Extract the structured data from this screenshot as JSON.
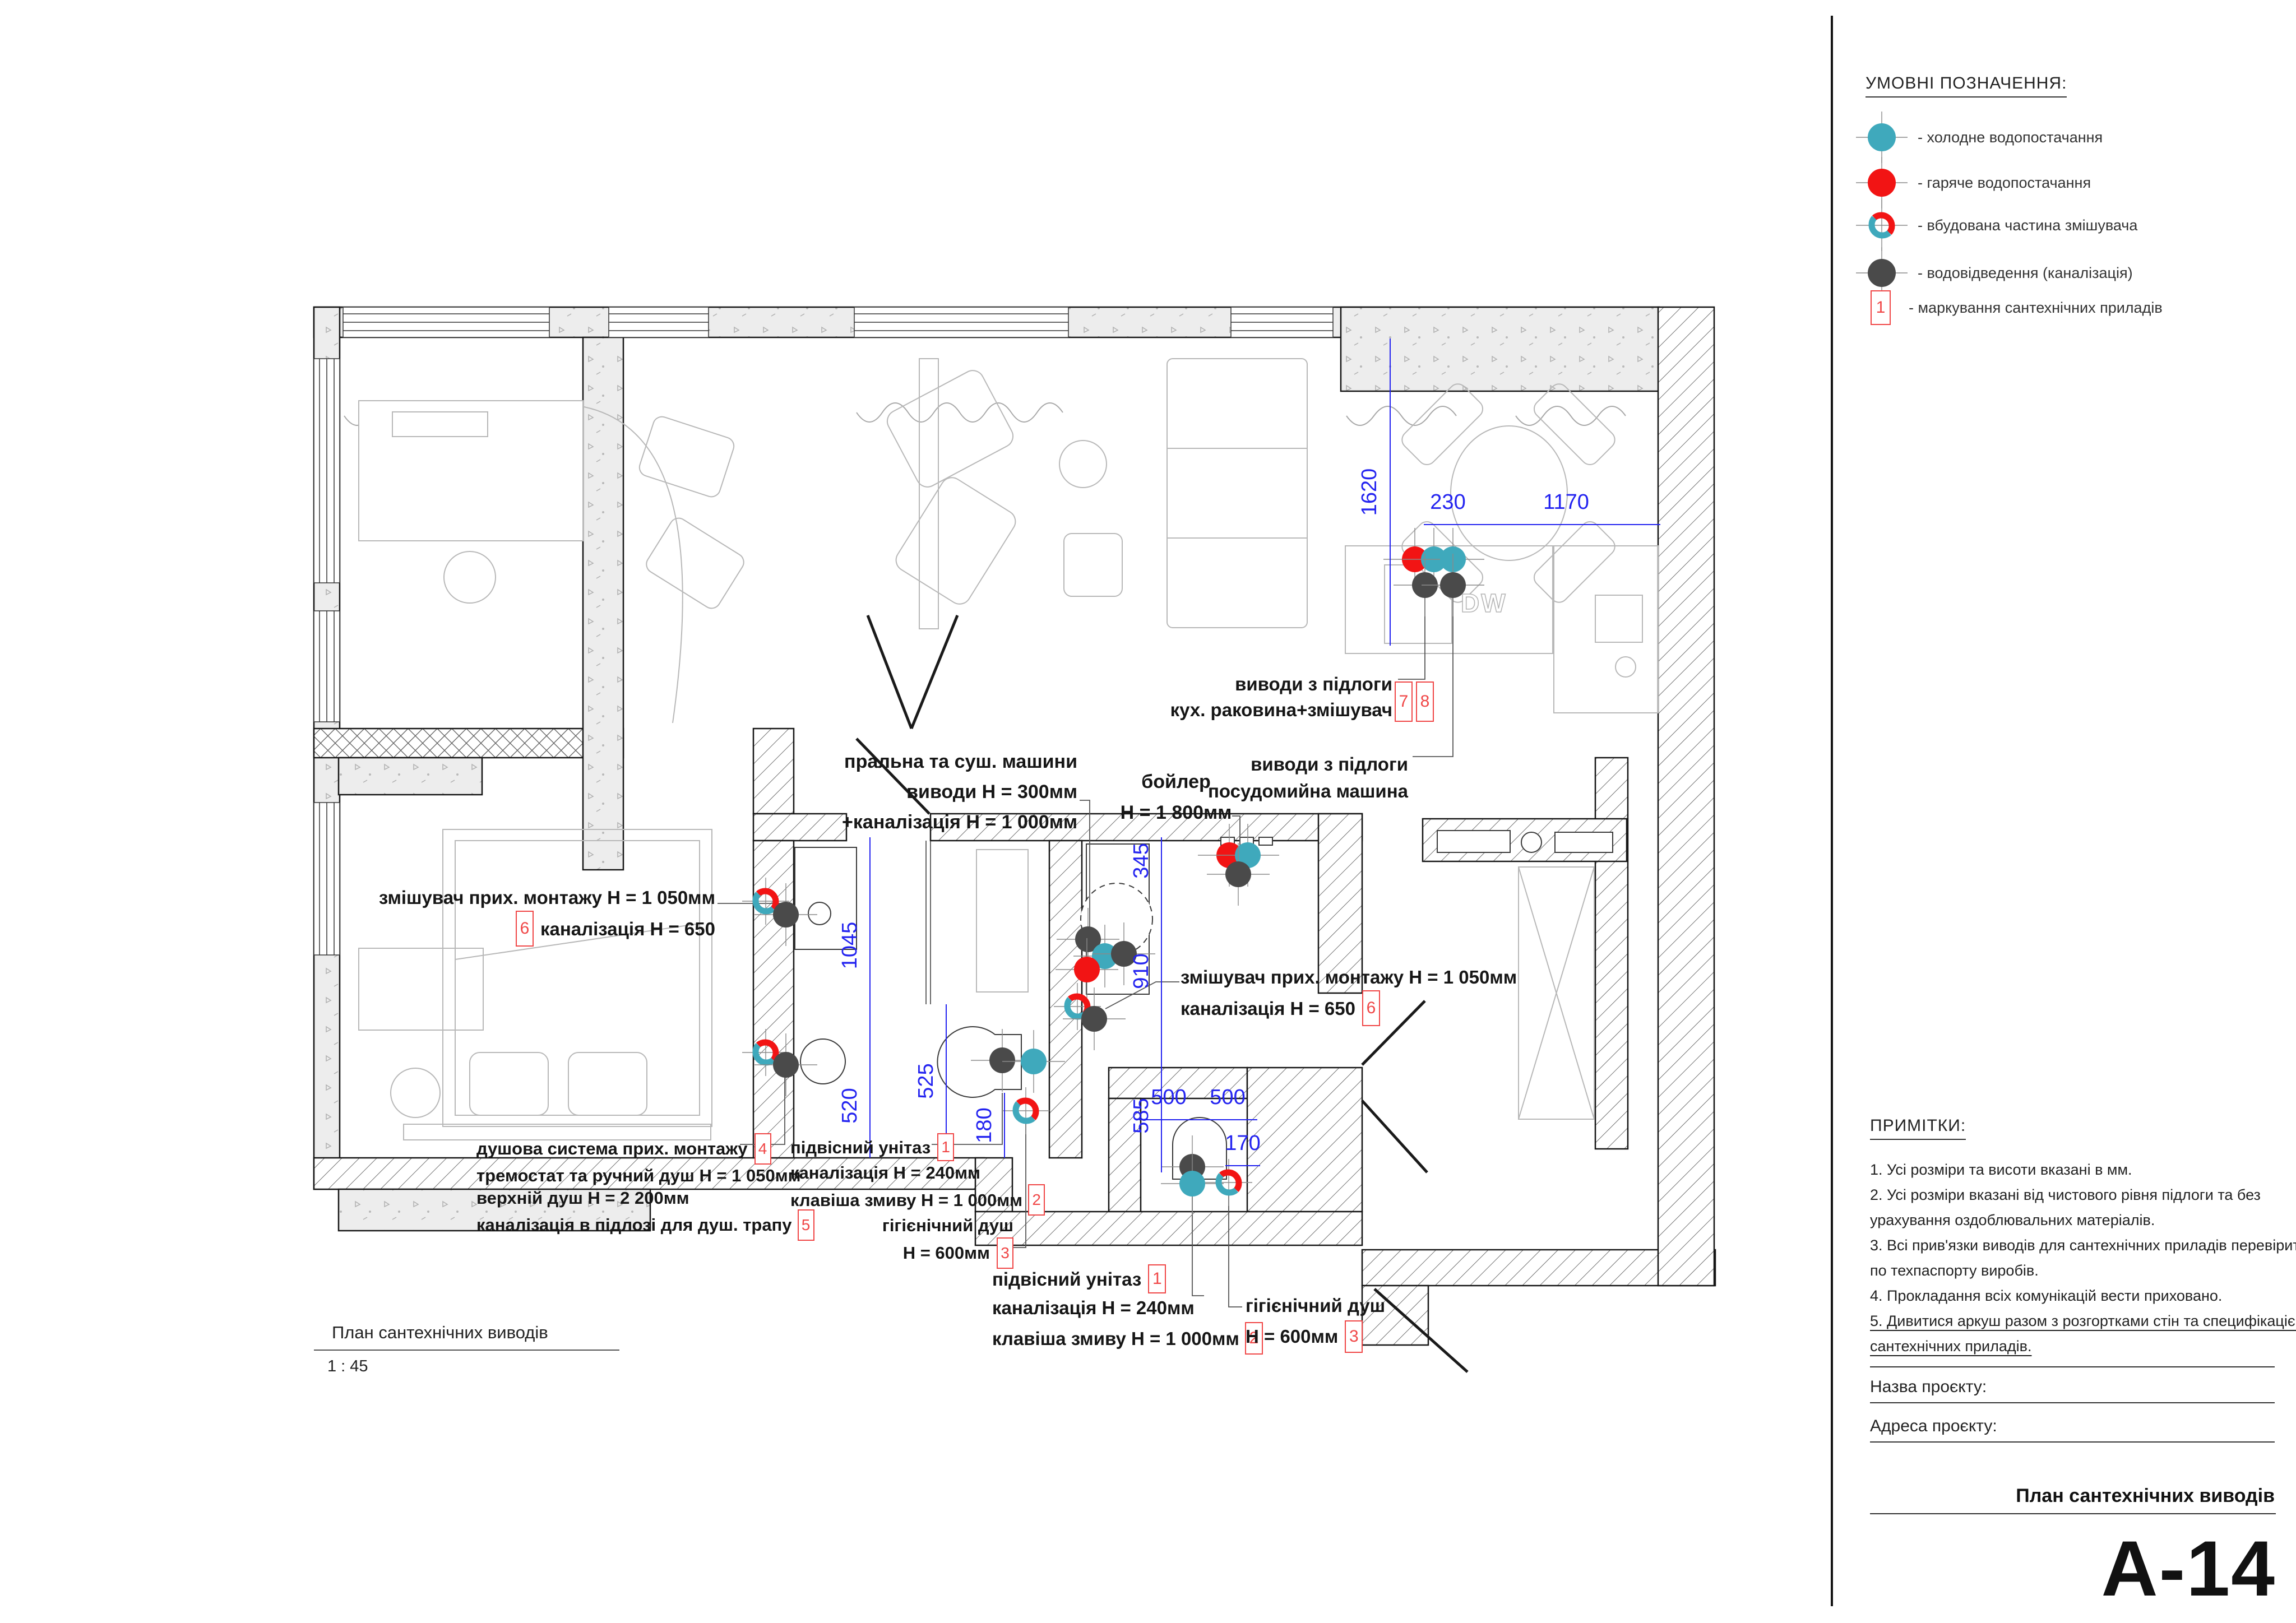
{
  "legend": {
    "title": "УМОВНІ ПОЗНАЧЕННЯ:",
    "items": [
      {
        "key": "cold",
        "label": "- холодне водопостачання"
      },
      {
        "key": "hot",
        "label": "- гаряче водопостачання"
      },
      {
        "key": "mixer",
        "label": "- вбудована частина змішувача"
      },
      {
        "key": "drain",
        "label": "- водовідведення (каналізація)"
      },
      {
        "key": "number",
        "box": "1",
        "label": "- маркування сантехнічних приладів"
      }
    ]
  },
  "notes": {
    "title": "ПРИМІТКИ:",
    "lines": [
      "1. Усі розміри та висоти вказані в мм.",
      "2. Усі розміри вказані від чистового рівня підлоги та без",
      "урахування оздоблювальних матеріалів.",
      "3. Всі прив'язки виводів для сантехнічних приладів перевірити",
      "по техпаспорту виробів.",
      "4. Прокладання всіх комунікацій вести приховано.",
      "5. Дивитися аркуш разом з розгортками стін та специфікацією",
      "сантехнічних приладів."
    ]
  },
  "title_block": {
    "name_label": "Назва проєкту:",
    "address_label": "Адреса проєкту:",
    "sheet_title": "План сантехнічних виводів",
    "sheet_number": "А-14"
  },
  "plan_caption": {
    "title": "План сантехнічних виводів",
    "scale": "1 : 45"
  },
  "dims": {
    "v1620": "1620",
    "v230": "230",
    "v1170": "1170",
    "v345": "345",
    "v910": "910",
    "v585": "585",
    "v1045": "1045",
    "v520": "520",
    "v525": "525",
    "v180": "180",
    "v500a": "500",
    "v500b": "500",
    "v170": "170"
  },
  "labels": {
    "washer": {
      "l1": "пральна та суш. машини",
      "l2": "виводи Н = 300мм",
      "l3": "+каналізація Н = 1 000мм"
    },
    "boiler": {
      "l1": "бойлер",
      "l2": "Н = 1 800мм"
    },
    "sink_floor": {
      "l1": "виводи з підлоги",
      "l2": "кух. раковина+змішувач",
      "b1": "7",
      "b2": "8"
    },
    "dw_floor": {
      "l1": "виводи з підлоги",
      "l2": "посудомийна машина"
    },
    "mixer_left": {
      "l1": "змішувач прих. монтажу Н = 1 050мм",
      "b": "6",
      "l2": "каналізація Н = 650"
    },
    "mixer_right": {
      "l1": "змішувач прих. монтажу Н = 1 050мм",
      "l2": "каналізація Н = 650",
      "b": "6"
    },
    "shower": {
      "l1": "душова система прих. монтажу",
      "b1": "4",
      "l2": "тремостат та ручний душ Н = 1 050мм",
      "l3": "верхній душ Н = 2 200мм",
      "l4": "каналізація в підлозі для душ. трапу",
      "b2": "5"
    },
    "wc1": {
      "l1": "підвісний унітаз",
      "b1": "1",
      "l2": "каналізація Н = 240мм",
      "l3": "клавіша змиву Н = 1 000мм",
      "b2": "2"
    },
    "hyg1": {
      "l1": "гігієнічний душ",
      "l2": "Н = 600мм",
      "b": "3"
    },
    "wc2": {
      "l1": "підвісний унітаз",
      "b1": "1",
      "l2": "каналізація Н = 240мм",
      "l3": "клавіша змиву Н = 1 000мм",
      "b2": "2"
    },
    "hyg2": {
      "l1": "гігієнічний душ",
      "l2": "Н = 600мм",
      "b": "3"
    },
    "dw": "DW"
  },
  "colors": {
    "cold": "#3FA9BC",
    "hot": "#F21414",
    "drain": "#4A4A4A",
    "dim": "#2323F0",
    "marking": "#F04747"
  }
}
